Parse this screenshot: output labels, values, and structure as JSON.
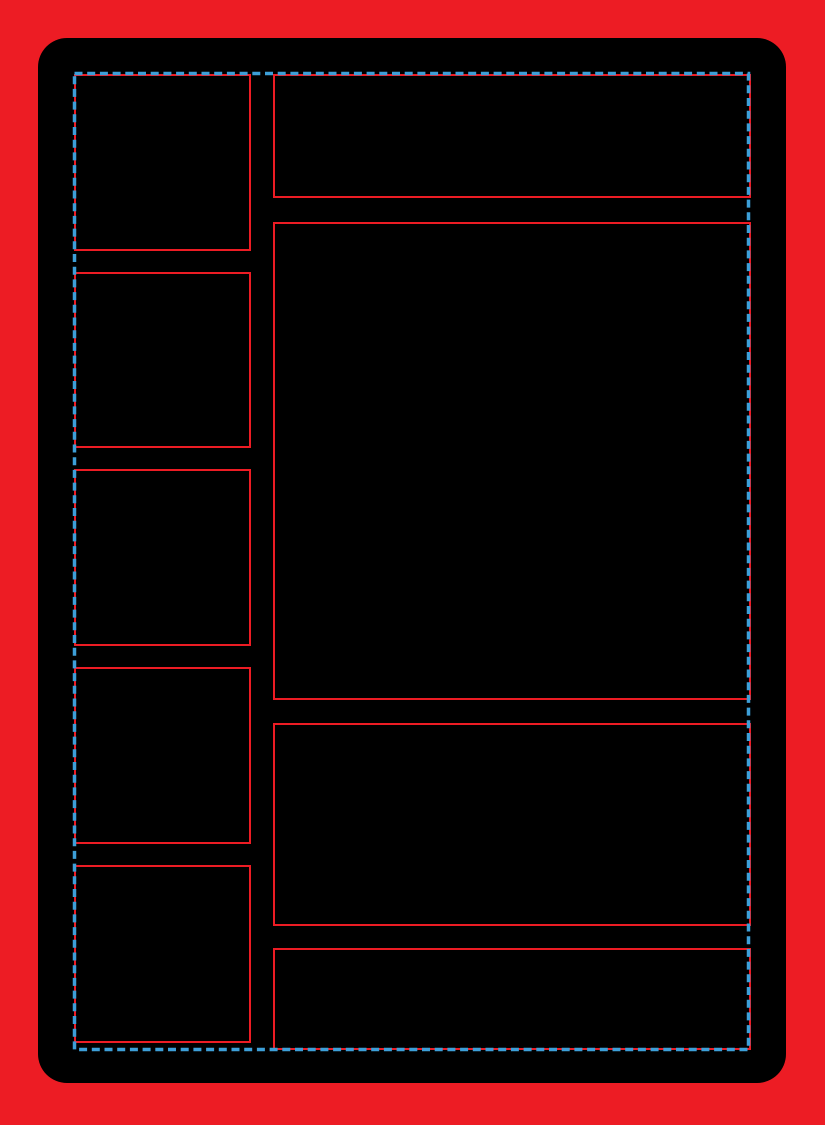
{
  "page": {
    "description": "Blank trading-card style layout template: black rounded card on a red background, red outlined content zones, and a blue dashed selection boundary around the content area."
  },
  "colors": {
    "background": "#ED1C24",
    "card": "#000000",
    "zone_outline": "#ED1C24",
    "selection_dash": "#3D9FD8"
  },
  "template": {
    "left_slot_count": 5,
    "right_zone_count": 4,
    "selection_style": "dashed"
  }
}
